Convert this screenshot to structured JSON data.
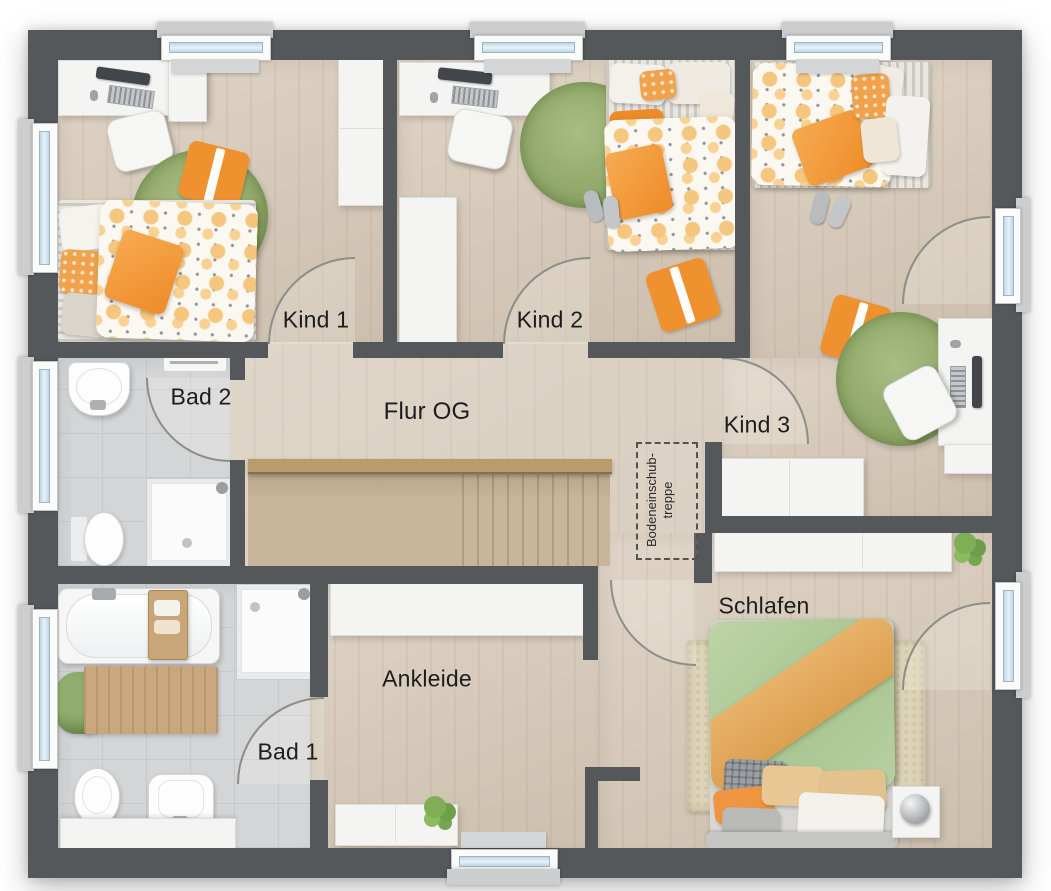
{
  "rooms": {
    "kind1": {
      "label": "Kind 1",
      "furniture": [
        "desk",
        "desk-chair",
        "single-bed",
        "round-rug",
        "wardrobe",
        "decorative-cushion"
      ]
    },
    "kind2": {
      "label": "Kind 2",
      "furniture": [
        "desk",
        "desk-chair",
        "single-bed",
        "round-rug",
        "wardrobe",
        "slippers",
        "floor-cushion"
      ]
    },
    "kind3": {
      "label": "Kind 3",
      "furniture": [
        "single-bed",
        "desk",
        "desk-chair",
        "round-rug",
        "sideboard",
        "slippers",
        "floor-cushion"
      ]
    },
    "bad2": {
      "label": "Bad 2",
      "furniture": [
        "washbasin",
        "toilet",
        "shower",
        "towel-rail"
      ]
    },
    "flur": {
      "label": "Flur OG",
      "furniture": [
        "staircase",
        "railing"
      ]
    },
    "bad1": {
      "label": "Bad 1",
      "furniture": [
        "bathtub",
        "shower",
        "toilet",
        "bidet",
        "vanity",
        "bath-mat",
        "towels"
      ]
    },
    "ankleide": {
      "label": "Ankleide",
      "furniture": [
        "wardrobe",
        "sideboard",
        "plant"
      ]
    },
    "schlafen": {
      "label": "Schlafen",
      "furniture": [
        "double-bed",
        "area-rug",
        "nightstand",
        "lamp",
        "sideboard",
        "plant"
      ]
    }
  },
  "attic_hatch": {
    "line1": "Bodeneinschub-",
    "line2": "treppe"
  },
  "windows": {
    "top": 3,
    "left": 3,
    "right": 2,
    "bottom": 1
  },
  "doors": 8,
  "colors": {
    "wall": "#55585b",
    "hall_floor": "#ddd2c2",
    "room_floor": "#d7c9b7",
    "bath_floor": "#d4d5d7",
    "stair_wood": "#c8b59c",
    "furniture_white": "#f4f4f3",
    "rug_green": "#8ba463",
    "accent_orange": "#f0912f",
    "bed_green": "#b2cc9c",
    "rug_beige": "#ddd3b8",
    "window_glass": "#cfe3ee",
    "label_text": "#1d1d1f"
  }
}
